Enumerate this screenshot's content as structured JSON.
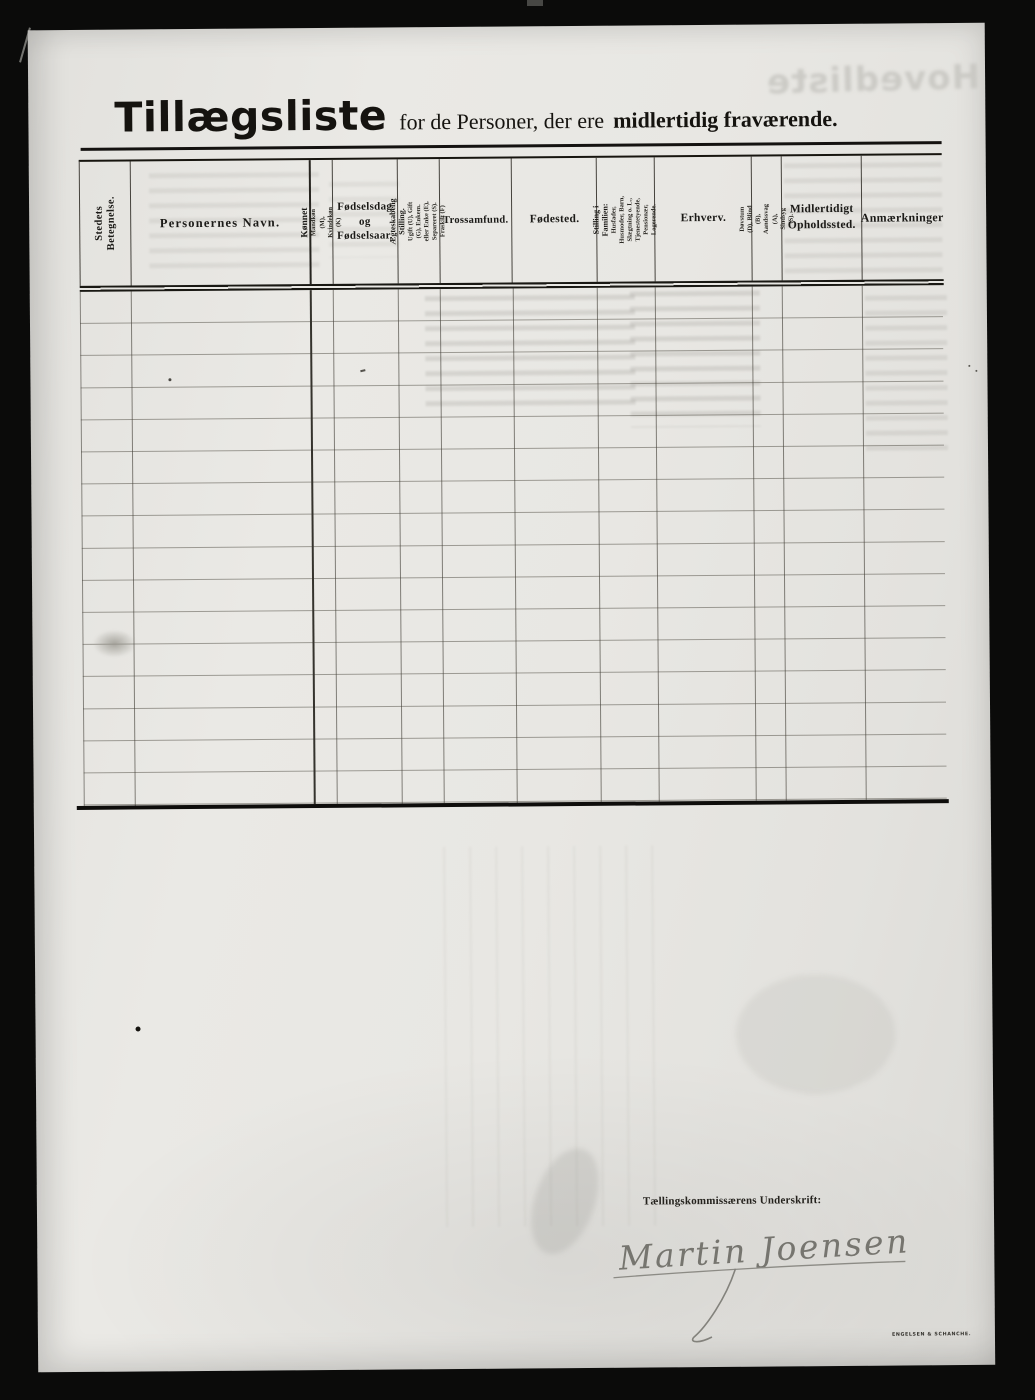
{
  "page": {
    "title": "Tillægsliste",
    "subtitle_regular": "for de Personer, der ere",
    "subtitle_bold": "midlertidig fraværende.",
    "bleedthrough_text": "Hovedliste"
  },
  "colors": {
    "paper": "#e8e7e3",
    "ink": "#1b1a17",
    "scanner_background": "#0b0b0a",
    "pencil_signature": "#76756f"
  },
  "table": {
    "row_count": 16,
    "rows_empty": true,
    "columns": [
      {
        "label": "Stedets Betegnelse.",
        "orientation": "vertical"
      },
      {
        "label": "Personernes Navn.",
        "orientation": "horizontal"
      },
      {
        "label": "Kønnet",
        "sub": "Mandkøn (M), Kvindekøn (K)",
        "orientation": "vertical"
      },
      {
        "label": "Fødselsdag og Fødselsaar.",
        "orientation": "horizontal"
      },
      {
        "label": "Ægteskabelig Stilling.",
        "sub": "Ugift (U), Gift (G), Enkem. eller Enke (E), Separeret (S). Fraskilt (F)",
        "orientation": "vertical"
      },
      {
        "label": "Trossamfund.",
        "orientation": "horizontal"
      },
      {
        "label": "Fødested.",
        "orientation": "horizontal"
      },
      {
        "label": "Stilling i Familien:",
        "sub": "Husfader, Husmoder, Barn, Slægtning o. L., Tjenestetyende, Pensionær, Logerende.",
        "orientation": "vertical"
      },
      {
        "label": "Erhverv.",
        "orientation": "horizontal"
      },
      {
        "label": "Døvstum (D), Blind (B), Aandssvag (A), Sindsyg (S).",
        "orientation": "vertical"
      },
      {
        "label": "Midlertidigt Opholdssted.",
        "orientation": "horizontal"
      },
      {
        "label": "Anmærkninger",
        "orientation": "horizontal"
      }
    ]
  },
  "footer": {
    "signature_label": "Tællingskommissærens Underskrift:",
    "signature_name": "Martin Joensen",
    "printer_mark": "ENGELSEN & SCHANCHE."
  }
}
